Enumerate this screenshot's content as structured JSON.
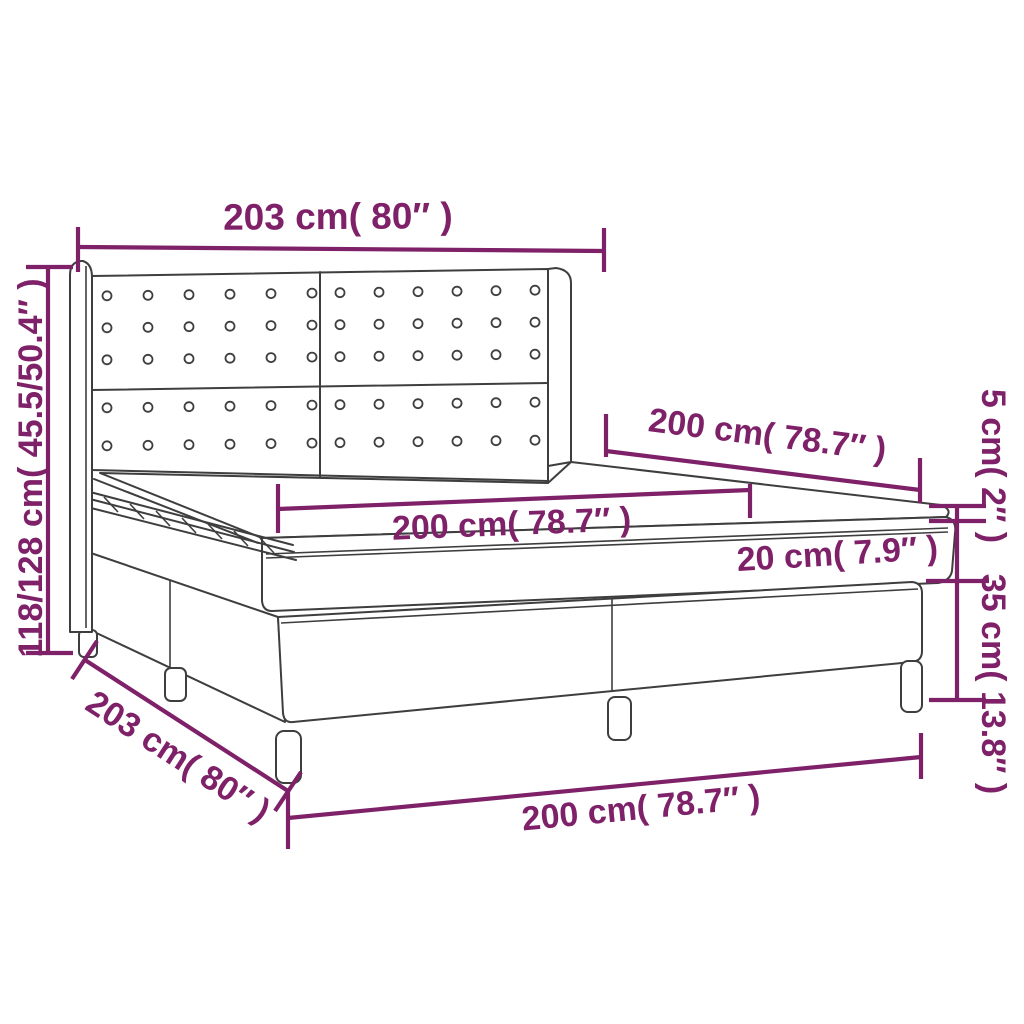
{
  "diagram": {
    "subject": "box spring bed with winged tufted headboard - dimension drawing",
    "colors": {
      "accent": "#7E2168",
      "line": "#3E3E3E",
      "background": "#FFFFFF"
    },
    "labels": {
      "headboard_width": "203 cm( 80″ )",
      "bed_height": "118/128 cm( 45.5/50.4″ )",
      "mattress_depth": "200 cm( 78.7″ )",
      "mattress_width": "200 cm( 78.7″ )",
      "mattress_thickness": "20 cm( 7.9″ )",
      "topper_thickness": "5 cm( 2″ )",
      "base_height": "35 cm( 13.8″ )",
      "frame_depth": "203 cm( 80″ )",
      "frame_front_width": "200 cm( 78.7″ )"
    }
  }
}
